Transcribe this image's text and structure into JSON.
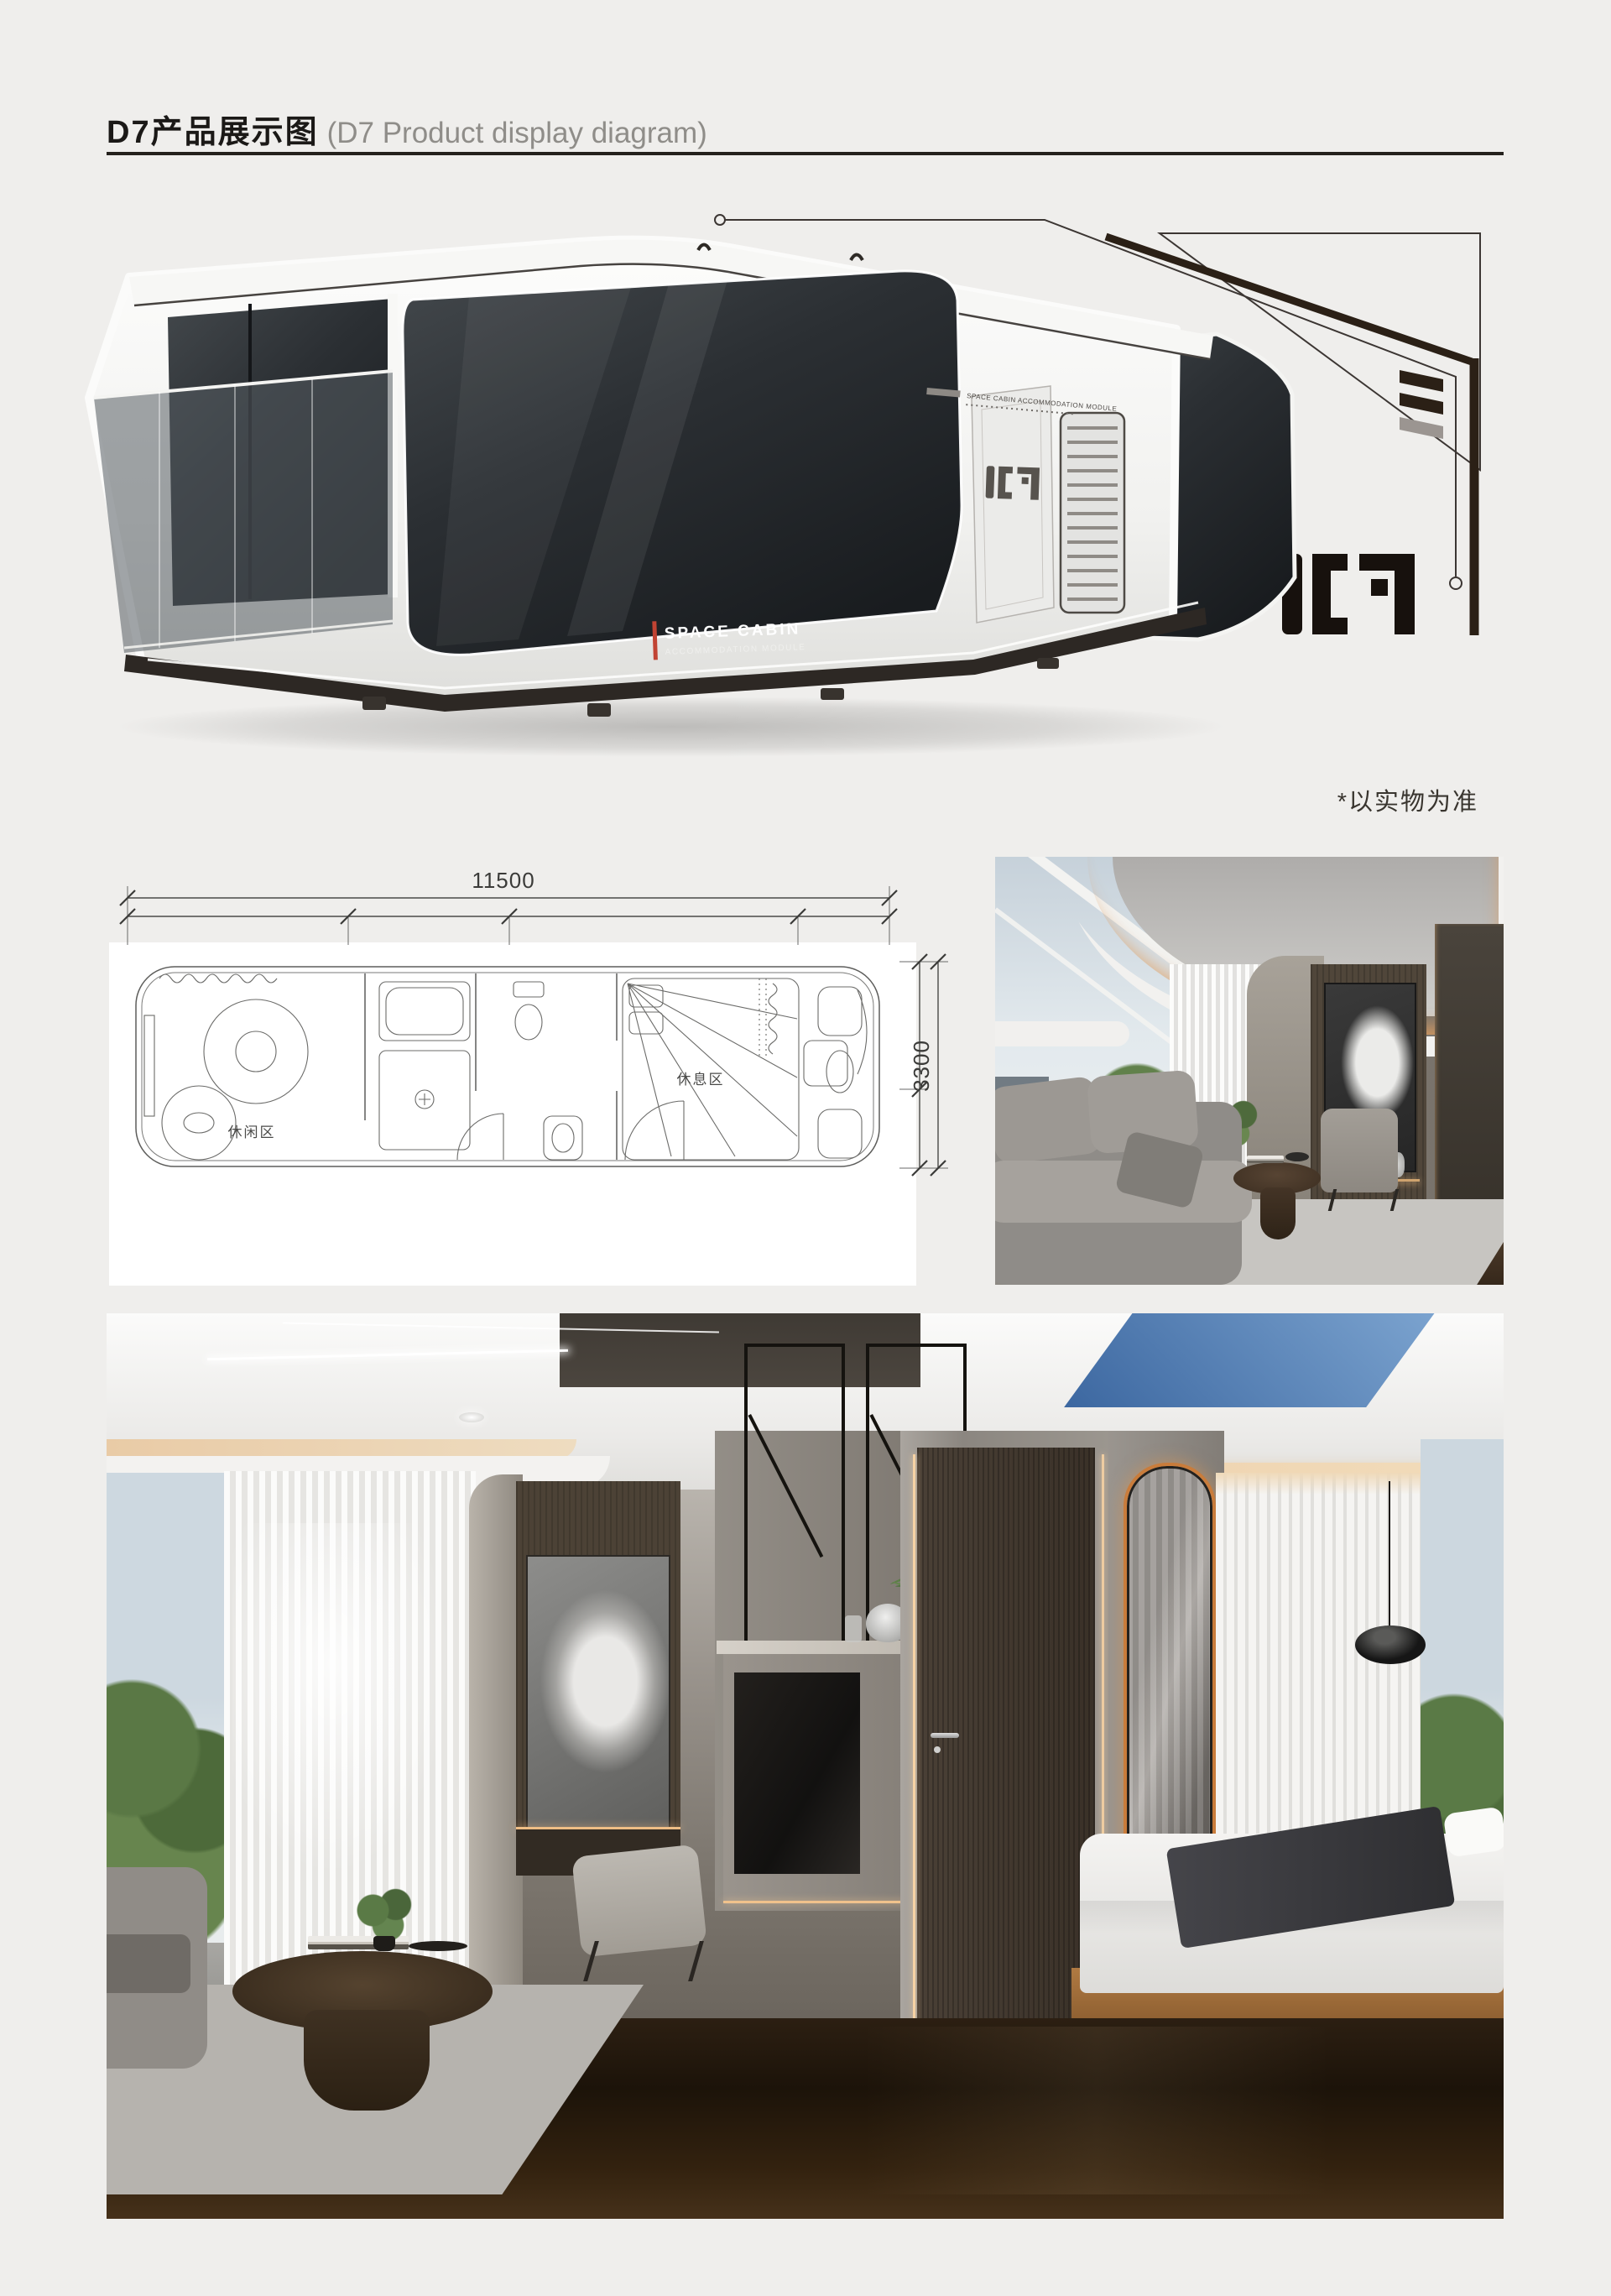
{
  "header": {
    "title_zh": "D7产品展示图",
    "title_en": "(D7 Product display diagram)"
  },
  "hero": {
    "brand_line1": "SPACE CABIN",
    "brand_line2": "ACCOMMODATION MODULE",
    "roof_label": "SPACE CABIN ACCOMMODATION MODULE",
    "logo_text": "D7",
    "disclaimer": "*以实物为准"
  },
  "floorplan": {
    "width_dim": "11500",
    "depth_dim": "3300",
    "label_lounge": "休闲区",
    "label_rest": "休息区"
  },
  "palette": {
    "page_bg": "#efeeec",
    "ink": "#1b1917",
    "title_gray": "#8f8d89",
    "rule": "#24211d",
    "line": "#3c3633",
    "line_thick": "#2b2016",
    "bar_gray": "#9b9591",
    "logo": "#17110d",
    "accent_red": "#c14333",
    "led_orange": "#d98e52",
    "panel_white": "#ffffff"
  }
}
